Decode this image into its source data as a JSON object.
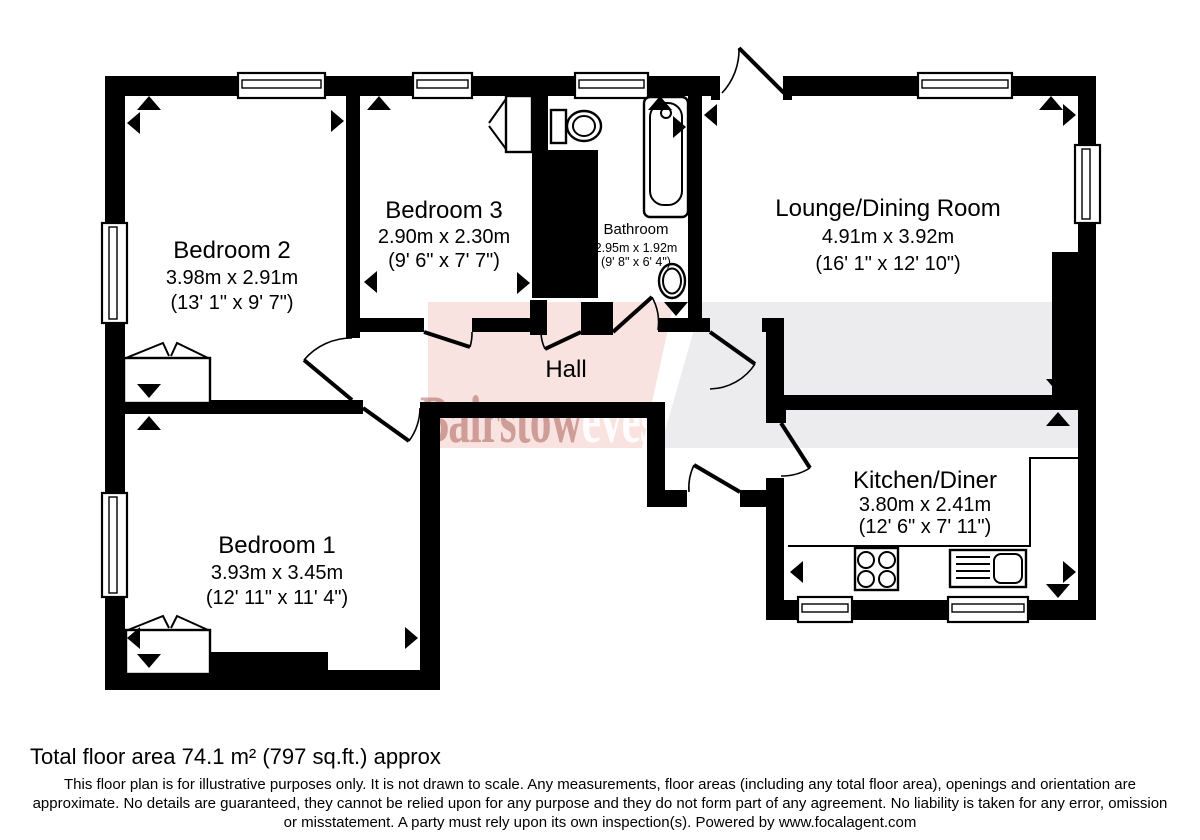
{
  "plan": {
    "rooms": [
      {
        "name": "Bedroom 2",
        "metric": "3.98m x 2.91m",
        "imperial": "(13' 1\" x 9' 7\")"
      },
      {
        "name": "Bedroom 3",
        "metric": "2.90m x 2.30m",
        "imperial": "(9' 6\" x 7' 7\")"
      },
      {
        "name": "Bathroom",
        "metric": "2.95m x 1.92m",
        "imperial": "(9' 8\" x 6' 4\")"
      },
      {
        "name": "Lounge/Dining Room",
        "metric": "4.91m x 3.92m",
        "imperial": "(16' 1\" x 12' 10\")"
      },
      {
        "name": "Hall",
        "metric": "",
        "imperial": ""
      },
      {
        "name": "Kitchen/Diner",
        "metric": "3.80m x 2.41m",
        "imperial": "(12' 6\" x 7' 11\")"
      },
      {
        "name": "Bedroom 1",
        "metric": "3.93m x 3.45m",
        "imperial": "(12' 11\" x 11' 4\")"
      }
    ],
    "watermark": {
      "part1": "Bairstow",
      "part2": "eves"
    },
    "colors": {
      "wall": "#000000",
      "pink_band": "#f8e3e1",
      "gray_band": "#ececee",
      "watermark_red": "#9c4a42",
      "watermark_white": "#ffffff"
    }
  },
  "footer": {
    "total_area": "Total floor area 74.1 m² (797 sq.ft.) approx",
    "disclaimer": "This floor plan is for illustrative purposes only. It is not drawn to scale. Any measurements, floor areas (including any total floor area), openings and orientation are approximate. No details are guaranteed, they cannot be relied upon for any purpose and they do not form part of any agreement. No liability is taken for any error, omission or misstatement. A party must rely upon its own inspection(s). Powered by www.focalagent.com"
  }
}
